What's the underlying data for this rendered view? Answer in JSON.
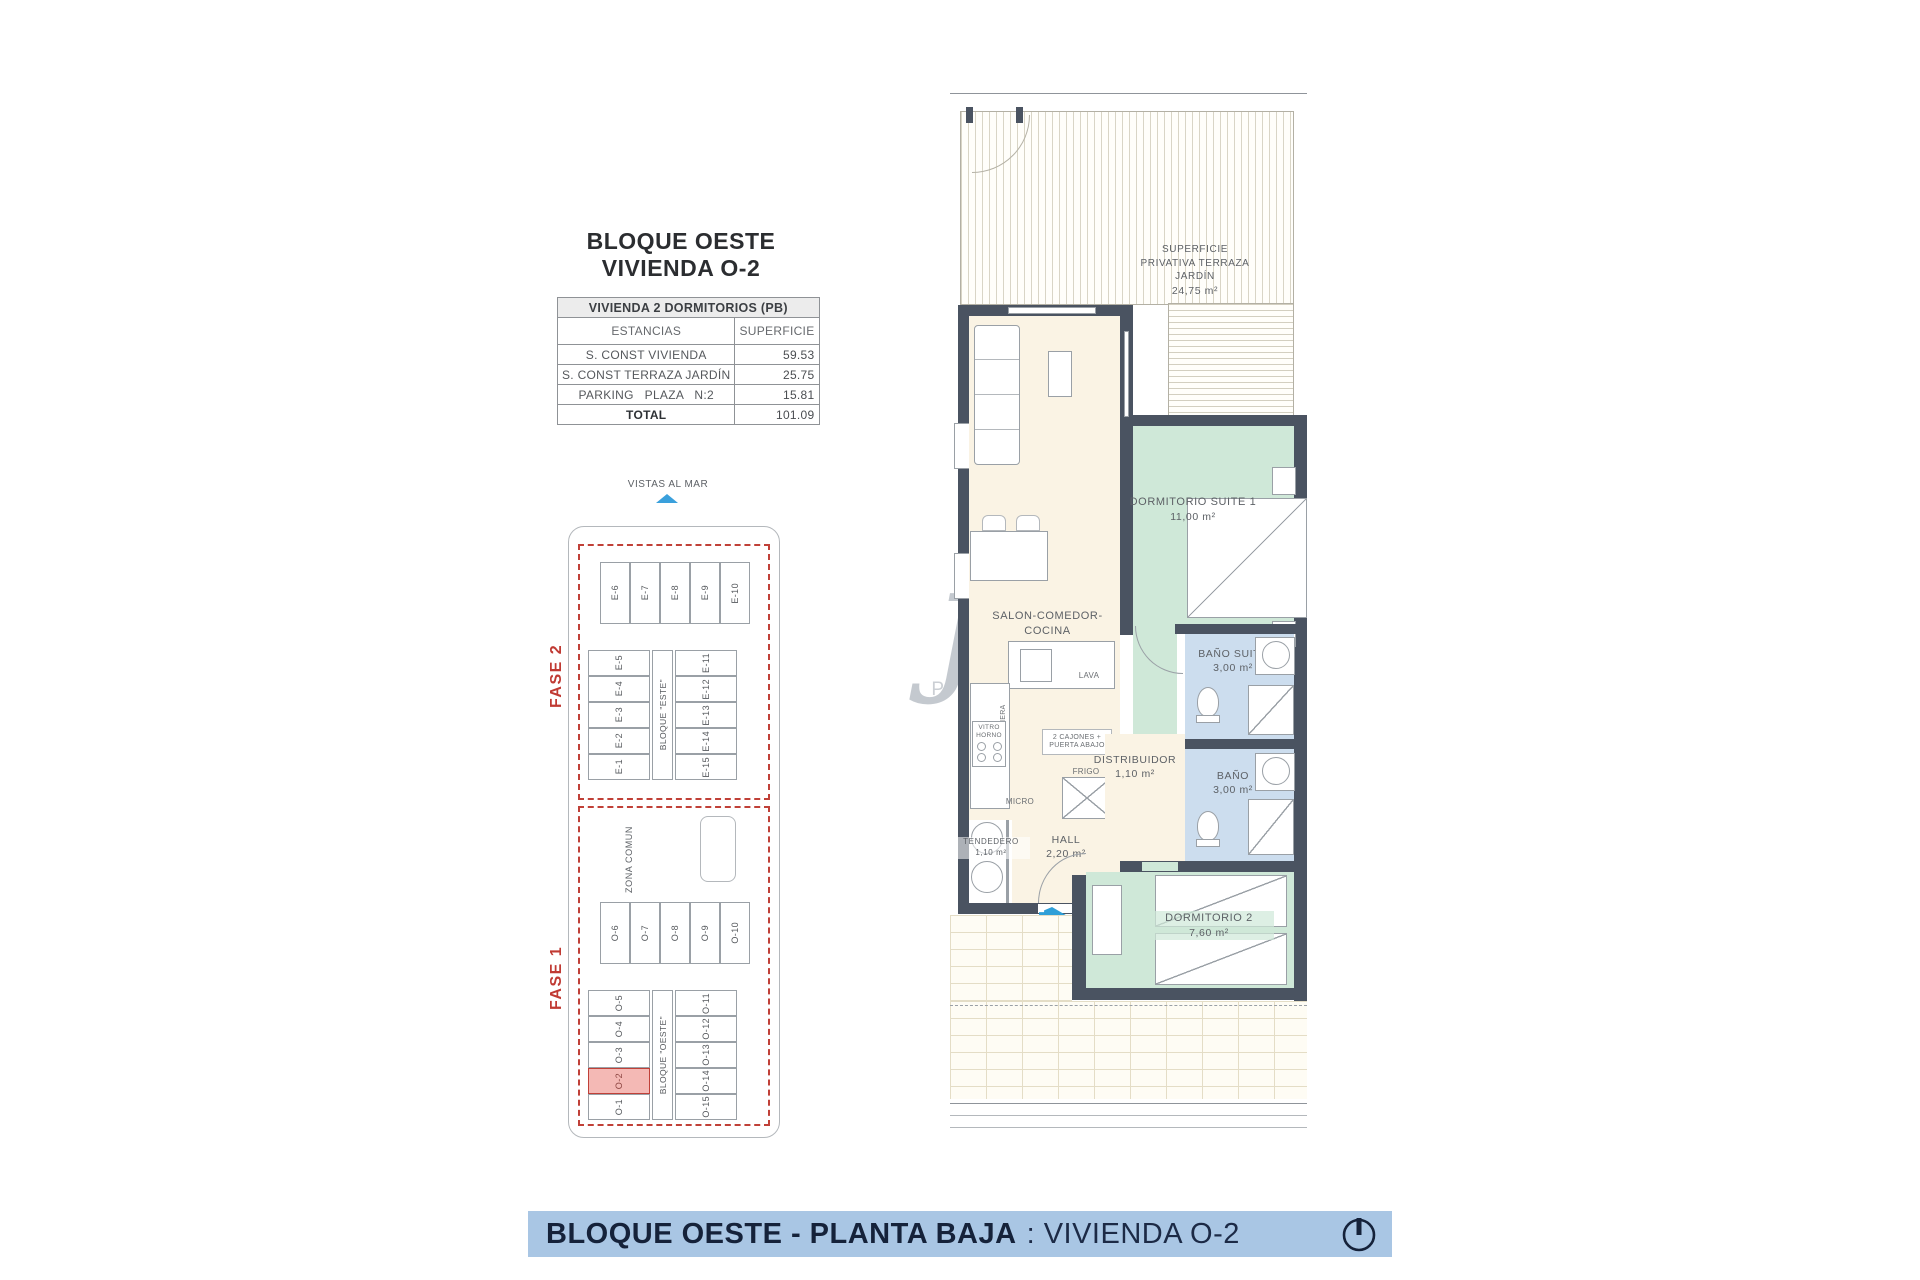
{
  "header": {
    "title_line1": "BLOQUE OESTE",
    "title_line2": "VIVIENDA O-2"
  },
  "summary_table": {
    "title": "VIVIENDA 2 DORMITORIOS (PB)",
    "col_estancias": "ESTANCIAS",
    "col_superficie": "SUPERFICIE",
    "rows": [
      {
        "label": "S. CONST VIVIENDA",
        "value": "59.53"
      },
      {
        "label": "S. CONST TERRAZA JARDÍN",
        "value": "25.75"
      },
      {
        "label": "PARKING   PLAZA   N:2",
        "value": "15.81"
      }
    ],
    "total_label": "TOTAL",
    "total_value": "101.09"
  },
  "site_plan": {
    "vistas_label": "VISTAS AL MAR",
    "fase2_label": "FASE 2",
    "fase1_label": "FASE 1",
    "zona_comun_label": "ZONA COMUN",
    "bloque_este_label": "BLOQUE \"ESTE\"",
    "bloque_oeste_label": "BLOQUE \"OESTE\"",
    "este_top_units": [
      "E-6",
      "E-7",
      "E-8",
      "E-9",
      "E-10"
    ],
    "este_left_units": [
      "E-5",
      "E-4",
      "E-3",
      "E-2",
      "E-1"
    ],
    "este_right_units": [
      "E-11",
      "E-12",
      "E-13",
      "E-14",
      "E-15"
    ],
    "oeste_top_units": [
      "O-6",
      "O-7",
      "O-8",
      "O-9",
      "O-10"
    ],
    "oeste_left_units": [
      "O-5",
      "O-4",
      "O-3",
      "O-2",
      "O-1"
    ],
    "oeste_right_units": [
      "O-11",
      "O-12",
      "O-13",
      "O-14",
      "O-15"
    ],
    "highlighted_unit": "O-2"
  },
  "floor_plan": {
    "terrace_line1": "SUPERFICIE",
    "terrace_line2": "PRIVATIVA TERRAZA",
    "terrace_line3": "JARDÍN",
    "terrace_area": "24,75 m²",
    "salon_name": "SALON-COMEDOR-COCINA",
    "salon_area": "23,50 m²",
    "suite_name": "DORMITORIO SUITE 1",
    "suite_area": "11,00 m²",
    "bano_suite_name": "BAÑO SUITE",
    "bano_suite_area": "3,00 m²",
    "bano_name": "BAÑO",
    "bano_area": "3,00 m²",
    "distribuidor_name": "DISTRIBUIDOR",
    "distribuidor_area": "1,10 m²",
    "hall_name": "HALL",
    "hall_area": "2,20 m²",
    "tendedero_name": "TENDEDERO",
    "tendedero_area": "1,10 m²",
    "dorm2_name": "DORMITORIO 2",
    "dorm2_area": "7,60 m²",
    "kitchen": {
      "lava": "LAVA",
      "cajonera": "CAJONERA",
      "vitro": "VITRO",
      "horno": "HORNO",
      "cajones_line1": "2 CAJONES +",
      "cajones_line2": "PUERTA ABAJO",
      "frigo": "FRIGO",
      "micro": "MICRO"
    },
    "unit_tag": "O-2"
  },
  "watermark": {
    "letter": "j",
    "text": "P E"
  },
  "footer": {
    "bold_text": "BLOQUE OESTE - PLANTA BAJA",
    "regular_text": ": VIVIENDA O-2"
  },
  "colors": {
    "wall": "#4a5361",
    "cream_room": "#faf3e4",
    "green_room": "#cfe8d8",
    "blue_room": "#ccddee",
    "fase_red": "#c03a33",
    "highlight_pink": "#f4b9b5",
    "accent_blue": "#2f9fd8",
    "banner_blue": "#a9c6e4",
    "banner_text": "#15223a"
  }
}
